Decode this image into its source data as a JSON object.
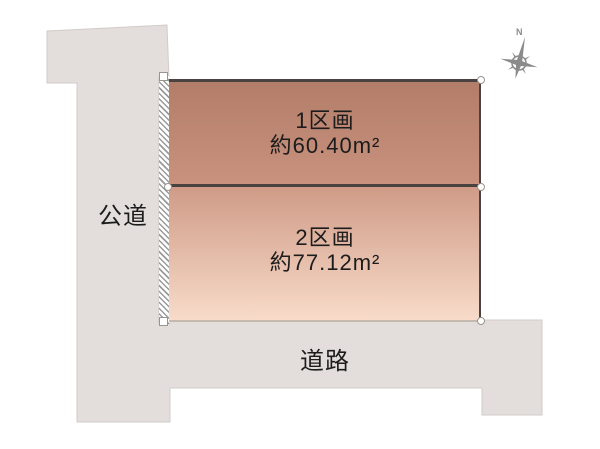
{
  "diagram": {
    "public_road_label": "公道",
    "front_road_label": "道路",
    "lots": [
      {
        "name": "1区画",
        "area": "約60.40m²"
      },
      {
        "name": "2区画",
        "area": "約77.12m²"
      }
    ],
    "compass_north_label": "N"
  },
  "colors": {
    "road_fill": "#e3dedb",
    "road_stroke": "#d2ccc9",
    "lot1_top": "#b27d69",
    "lot1_bottom": "#c8927e",
    "lot2_top": "#cf9b87",
    "lot2_bottom": "#f8dbc9",
    "border_dark": "#4a4240",
    "lot2_border_bottom": "#c4b9ac",
    "hatch_line": "#9a9a9a",
    "compass_gray": "#8b8b8b",
    "ink": "#1c1c1c"
  }
}
